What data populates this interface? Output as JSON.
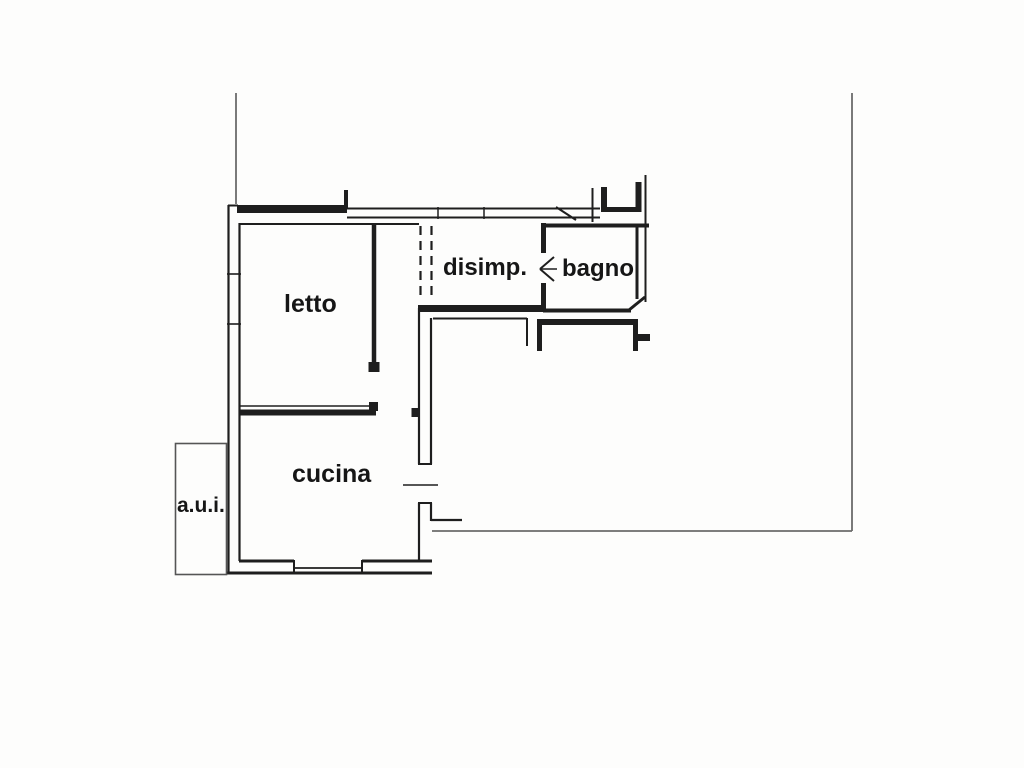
{
  "rooms": {
    "letto": {
      "label": "letto"
    },
    "disimp": {
      "label": "disimp."
    },
    "bagno": {
      "label": "bagno"
    },
    "cucina": {
      "label": "cucina"
    },
    "aui": {
      "label": "a.u.i."
    }
  },
  "colors": {
    "wall": "#1e1e1e",
    "thin_line": "#6b6b6b",
    "background": "#fdfdfc"
  }
}
